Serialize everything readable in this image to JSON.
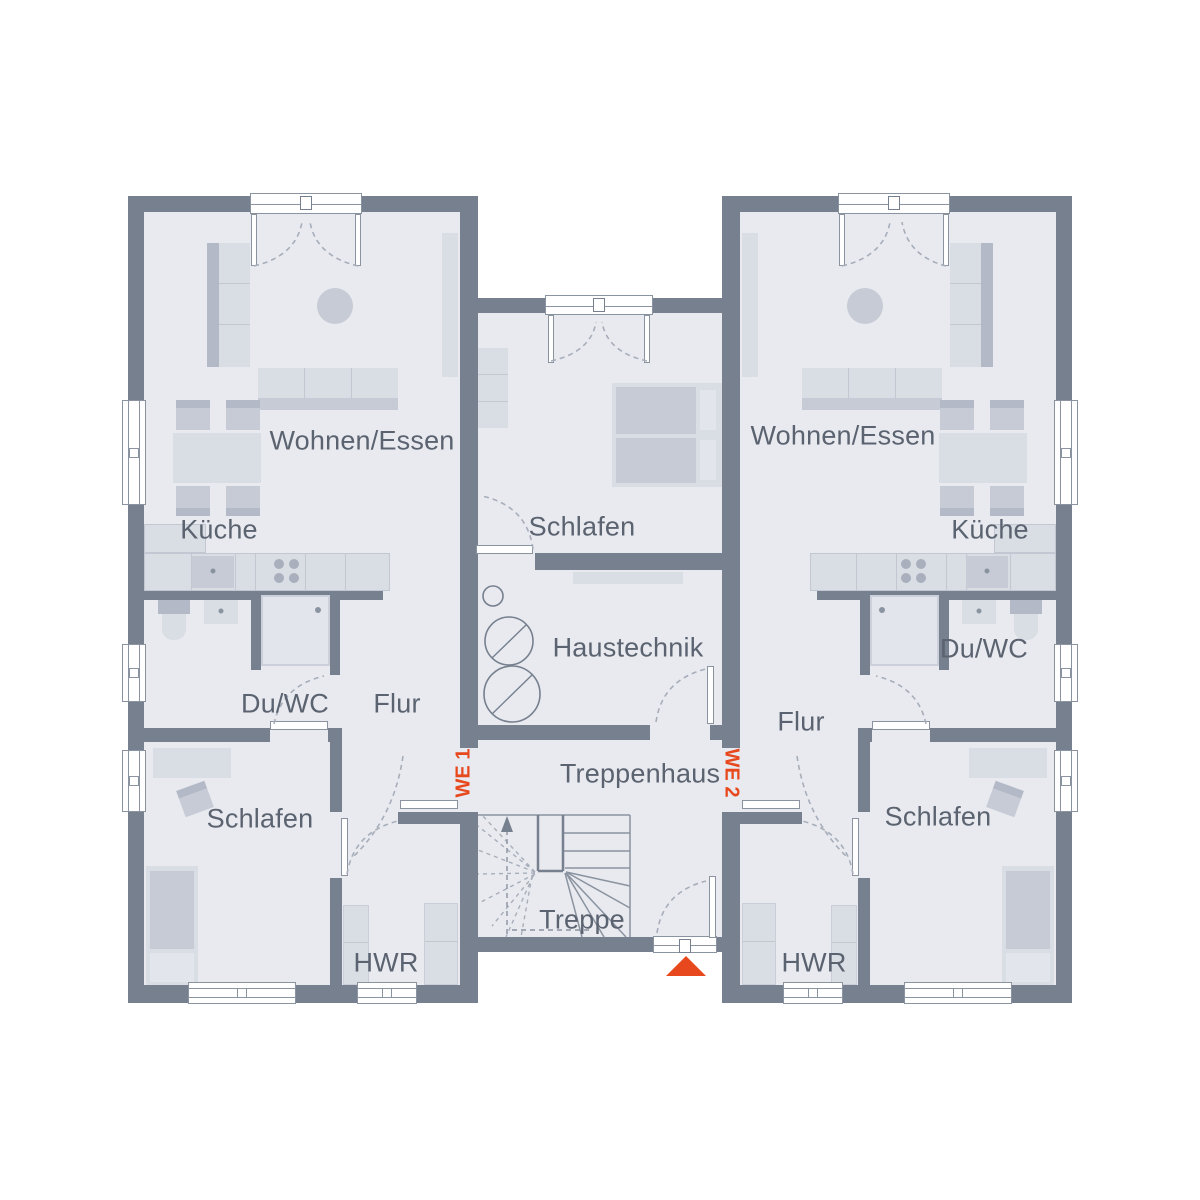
{
  "colors": {
    "wall": "#76808E",
    "floor": "#E8EAEF",
    "fur_light": "#D9DDE4",
    "fur_mid": "#C6CBD5",
    "fur_dark": "#B3B9C6",
    "pale": "#E2E5EB",
    "line": "#8A93A0",
    "dash": "#A7AEBA",
    "text": "#5B6370",
    "accent": "#E8481E"
  },
  "unit1": {
    "id": "WE 1",
    "wohnen_essen": "Wohnen/Essen",
    "kueche": "Küche",
    "du_wc": "Du/WC",
    "flur": "Flur",
    "schlafen": "Schlafen",
    "hwr": "HWR"
  },
  "unit2": {
    "id": "WE 2",
    "wohnen_essen": "Wohnen/Essen",
    "kueche": "Küche",
    "du_wc": "Du/WC",
    "flur": "Flur",
    "schlafen": "Schlafen",
    "hwr": "HWR"
  },
  "core": {
    "schlafen": "Schlafen",
    "haustechnik": "Haustechnik",
    "treppenhaus": "Treppenhaus",
    "treppe": "Treppe"
  }
}
